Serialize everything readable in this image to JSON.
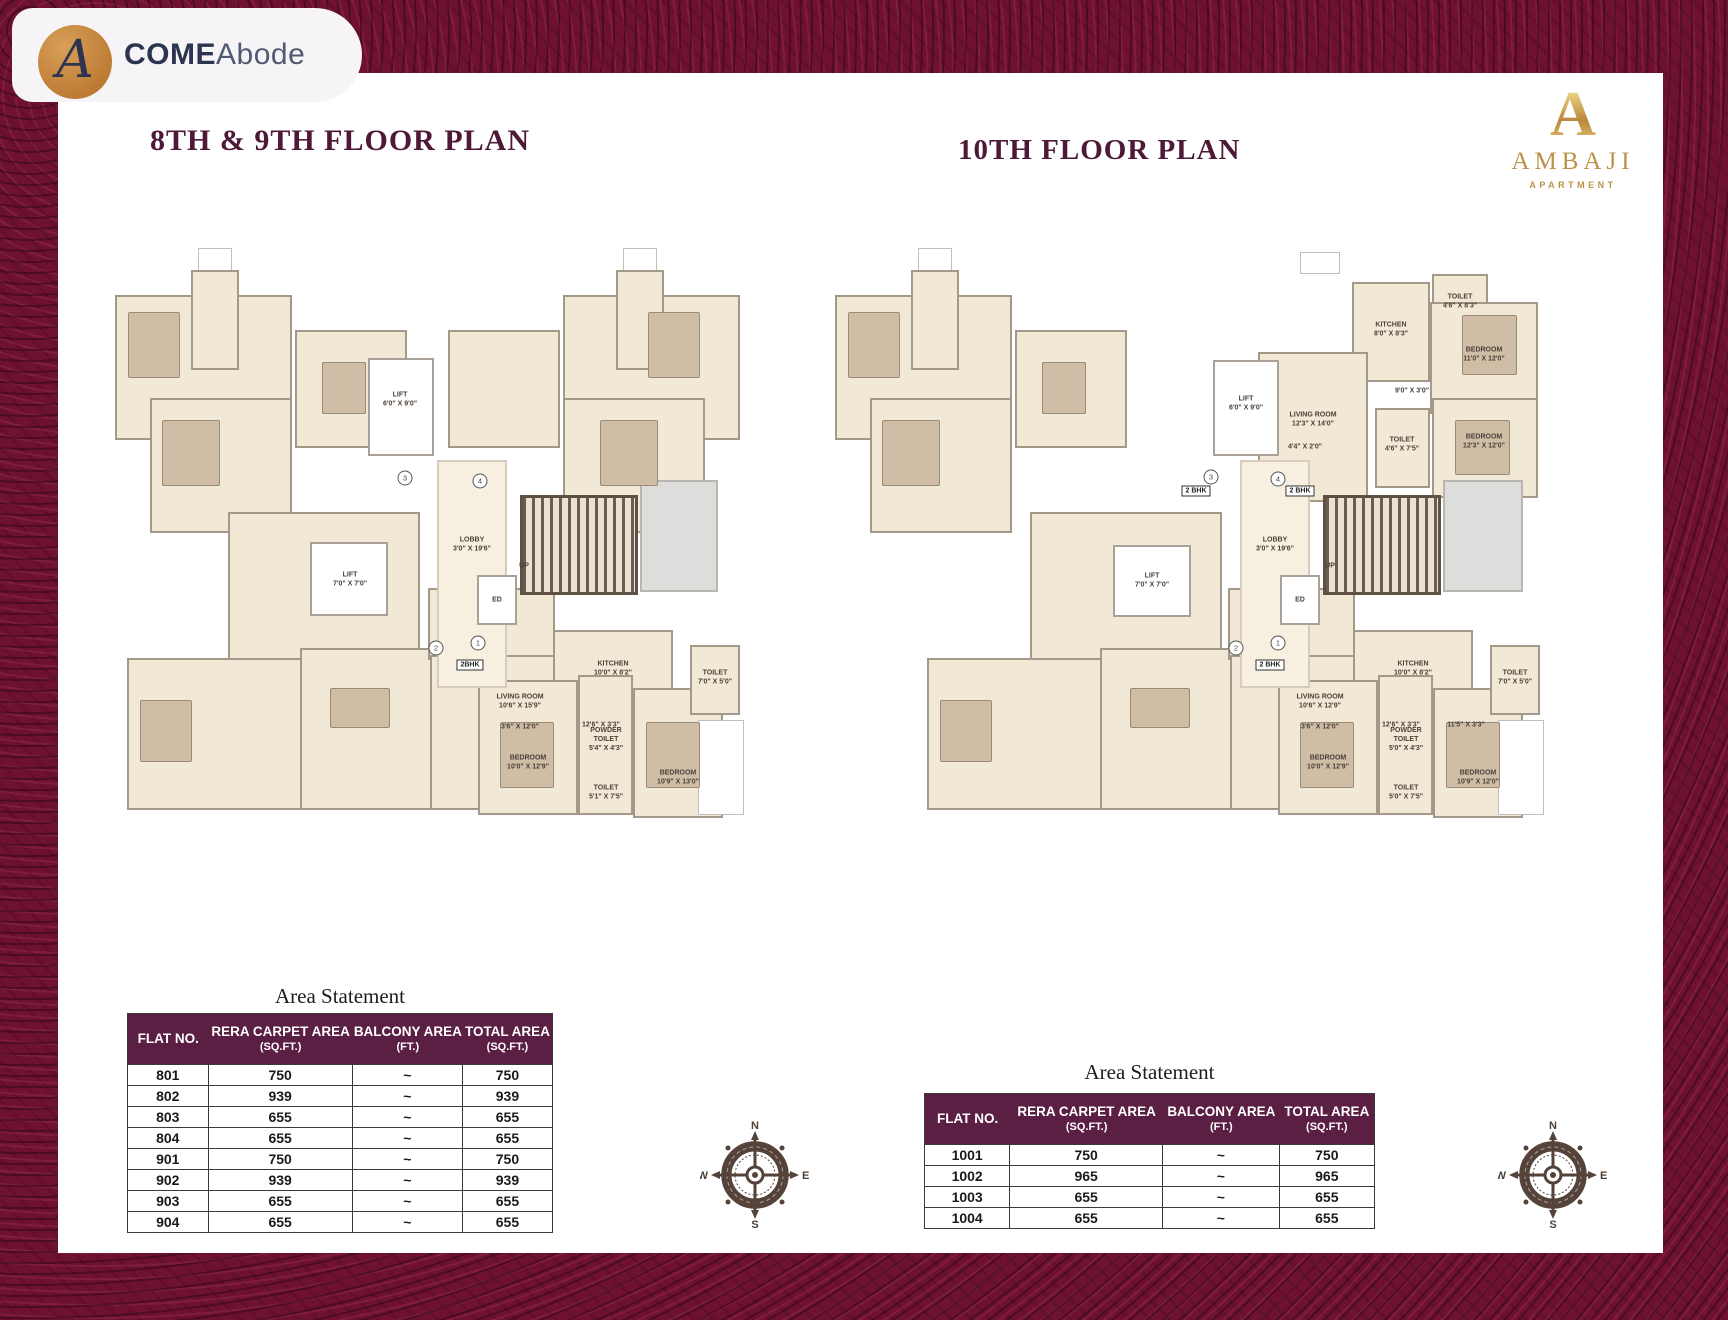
{
  "brand": {
    "monogram": "A",
    "come": "COME",
    "abode": "Abode"
  },
  "project": {
    "monogram": "A",
    "name": "AMBAJI",
    "type": "APARTMENT"
  },
  "sections": {
    "left_title": "8TH & 9TH FLOOR PLAN",
    "right_title": "10TH FLOOR PLAN",
    "area_statement_title": "Area Statement"
  },
  "tables": {
    "headers": {
      "flat": "FLAT NO.",
      "rera": "RERA CARPET AREA",
      "rera_unit": "(SQ.FT.)",
      "balcony": "BALCONY AREA",
      "balcony_unit": "(FT.)",
      "total": "TOTAL AREA",
      "total_unit": "(SQ.FT.)"
    },
    "left_rows": [
      {
        "flat": "801",
        "rera": "750",
        "balcony": "~",
        "total": "750"
      },
      {
        "flat": "802",
        "rera": "939",
        "balcony": "~",
        "total": "939"
      },
      {
        "flat": "803",
        "rera": "655",
        "balcony": "~",
        "total": "655"
      },
      {
        "flat": "804",
        "rera": "655",
        "balcony": "~",
        "total": "655"
      },
      {
        "flat": "901",
        "rera": "750",
        "balcony": "~",
        "total": "750"
      },
      {
        "flat": "902",
        "rera": "939",
        "balcony": "~",
        "total": "939"
      },
      {
        "flat": "903",
        "rera": "655",
        "balcony": "~",
        "total": "655"
      },
      {
        "flat": "904",
        "rera": "655",
        "balcony": "~",
        "total": "655"
      }
    ],
    "right_rows": [
      {
        "flat": "1001",
        "rera": "750",
        "balcony": "~",
        "total": "750"
      },
      {
        "flat": "1002",
        "rera": "965",
        "balcony": "~",
        "total": "965"
      },
      {
        "flat": "1003",
        "rera": "655",
        "balcony": "~",
        "total": "655"
      },
      {
        "flat": "1004",
        "rera": "655",
        "balcony": "~",
        "total": "655"
      }
    ]
  },
  "compass": {
    "n": "N",
    "e": "E",
    "s": "S",
    "w": "W"
  },
  "markers": {
    "bhk_left": "2BHK",
    "bhk_right": "2 BHK",
    "c1": "1",
    "c2": "2",
    "c3": "3",
    "c4": "4"
  },
  "plans": {
    "left": {
      "rooms": [
        "LIFT\n6'0\" X 9'0\"",
        "LOBBY\n3'0\" X 19'6\"",
        "LIFT\n7'0\" X 7'0\"",
        "ED",
        "UP",
        "KITCHEN\n10'0\" X 8'2\"",
        "LIVING ROOM\n10'6\" X 15'9\"",
        "3'6\" X 12'0\"",
        "12'6\" X 3'3\"",
        "BEDROOM\n10'0\" X 12'9\"",
        "POWDER\nTOILET\n5'4\" X 4'3\"",
        "TOILET\n5'1\" X 7'5\"",
        "TOILET\n7'0\" X 5'0\"",
        "BEDROOM\n10'9\" X 13'0\""
      ]
    },
    "right": {
      "rooms": [
        "LIFT\n6'0\" X 9'0\"",
        "LOBBY\n3'0\" X 19'6\"",
        "LIFT\n7'0\" X 7'0\"",
        "ED",
        "UP",
        "KITCHEN\n10'0\" X 8'2\"",
        "LIVING ROOM\n10'6\" X 12'9\"",
        "3'6\" X 12'0\"",
        "12'6\" X 3'3\"",
        "11'5\" X 3'3\"",
        "BEDROOM\n10'0\" X 12'9\"",
        "POWDER\nTOILET\n5'0\" X 4'3\"",
        "TOILET\n5'0\" X 7'5\"",
        "TOILET\n7'0\" X 5'0\"",
        "BEDROOM\n10'9\" X 12'0\"",
        "KITCHEN\n8'0\" X 8'3\"",
        "TOILET\n4'6\" X 8'3\"",
        "BEDROOM\n11'0\" X 12'0\"",
        "9'0\" X 3'0\"",
        "BEDROOM\n12'3\" X 12'0\"",
        "TOILET\n4'6\" X 7'5\"",
        "LIVING ROOM\n12'3\" X 14'0\"",
        "4'4\" X 2'0\""
      ]
    }
  }
}
